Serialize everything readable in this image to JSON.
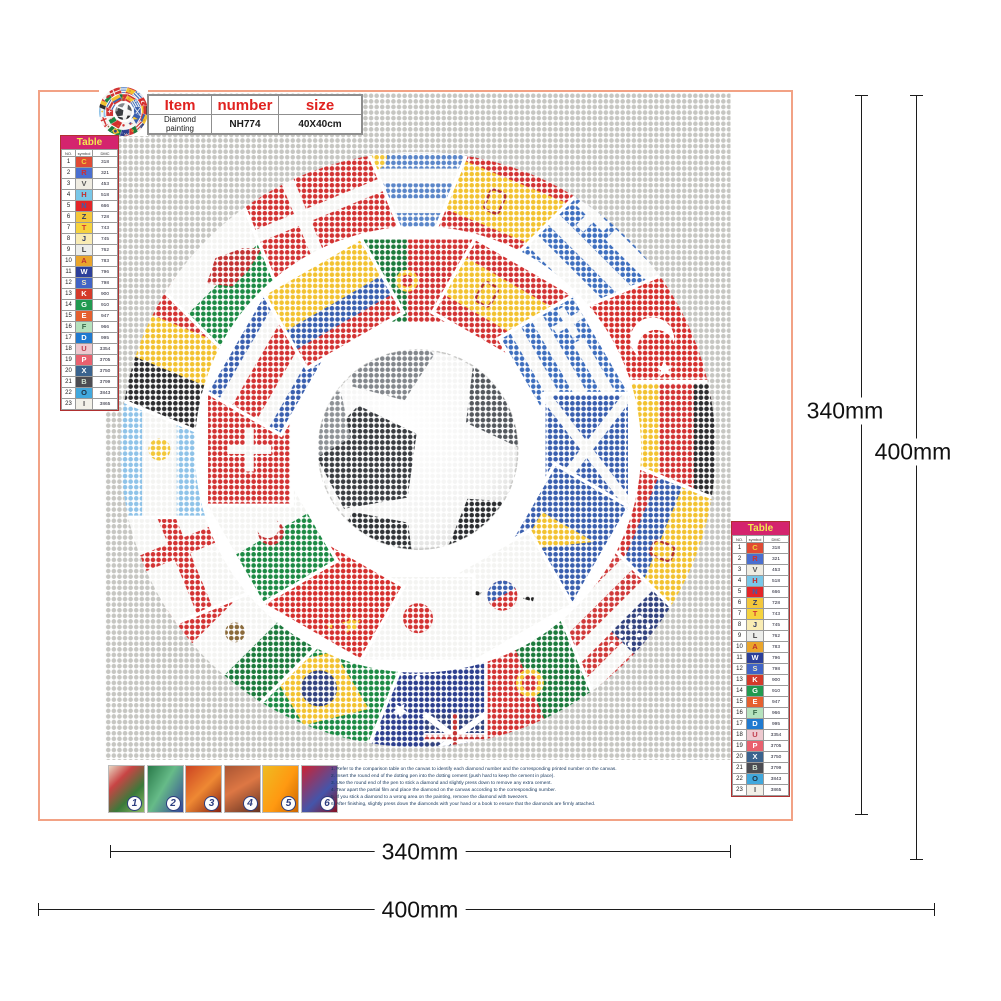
{
  "header": {
    "columns": [
      "Item",
      "number",
      "size"
    ],
    "product": "Diamond painting",
    "number": "NH774",
    "size": "40X40cm"
  },
  "color_table": {
    "title": "Table",
    "headers": [
      "NO.",
      "symbol",
      "DMC"
    ],
    "rows": [
      {
        "no": "1",
        "symbol": "C",
        "code": "318",
        "bg": "#e04b35",
        "fg": "#f2d23a"
      },
      {
        "no": "2",
        "symbol": "R",
        "code": "321",
        "bg": "#4a6fd0",
        "fg": "#d03030"
      },
      {
        "no": "3",
        "symbol": "V",
        "code": "453",
        "bg": "#efece2",
        "fg": "#555555"
      },
      {
        "no": "4",
        "symbol": "H",
        "code": "518",
        "bg": "#79c7e8",
        "fg": "#c03030"
      },
      {
        "no": "5",
        "symbol": "N",
        "code": "666",
        "bg": "#e32528",
        "fg": "#3a5fae"
      },
      {
        "no": "6",
        "symbol": "Z",
        "code": "728",
        "bg": "#f3c73b",
        "fg": "#2e3a66"
      },
      {
        "no": "7",
        "symbol": "T",
        "code": "743",
        "bg": "#f6d33d",
        "fg": "#cf3333"
      },
      {
        "no": "8",
        "symbol": "J",
        "code": "745",
        "bg": "#f9ecb4",
        "fg": "#2e3a66"
      },
      {
        "no": "9",
        "symbol": "L",
        "code": "762",
        "bg": "#ecedea",
        "fg": "#444444"
      },
      {
        "no": "10",
        "symbol": "A",
        "code": "783",
        "bg": "#eaa52b",
        "fg": "#c03030"
      },
      {
        "no": "11",
        "symbol": "W",
        "code": "796",
        "bg": "#2c3f9a",
        "fg": "#ffffff"
      },
      {
        "no": "12",
        "symbol": "S",
        "code": "798",
        "bg": "#4064c6",
        "fg": "#f0e8c0"
      },
      {
        "no": "13",
        "symbol": "K",
        "code": "900",
        "bg": "#d43a2a",
        "fg": "#ffffff"
      },
      {
        "no": "14",
        "symbol": "G",
        "code": "910",
        "bg": "#219a50",
        "fg": "#ffffff"
      },
      {
        "no": "15",
        "symbol": "E",
        "code": "947",
        "bg": "#e5602f",
        "fg": "#ffffff"
      },
      {
        "no": "16",
        "symbol": "F",
        "code": "966",
        "bg": "#b5e2bd",
        "fg": "#3a6a4a"
      },
      {
        "no": "17",
        "symbol": "D",
        "code": "995",
        "bg": "#1f7ad0",
        "fg": "#ffffff"
      },
      {
        "no": "18",
        "symbol": "U",
        "code": "3354",
        "bg": "#edc9cf",
        "fg": "#c04050"
      },
      {
        "no": "19",
        "symbol": "P",
        "code": "3705",
        "bg": "#e9606e",
        "fg": "#ffffff"
      },
      {
        "no": "20",
        "symbol": "X",
        "code": "3750",
        "bg": "#3a638e",
        "fg": "#ffffff"
      },
      {
        "no": "21",
        "symbol": "B",
        "code": "3799",
        "bg": "#4c4c52",
        "fg": "#cfe0cf"
      },
      {
        "no": "22",
        "symbol": "O",
        "code": "3843",
        "bg": "#41a8dd",
        "fg": "#223344"
      },
      {
        "no": "23",
        "symbol": "I",
        "code": "3865",
        "bg": "#f2f0e8",
        "fg": "#555555"
      }
    ]
  },
  "dimensions": {
    "right_inner": "340mm",
    "right_outer": "400mm",
    "bottom_inner": "340mm",
    "bottom_outer": "400mm"
  },
  "steps": [
    {
      "n": "1",
      "text": "1. Refer to the comparison table on the canvas to identify each diamond number and the corresponding printed number on the canvas."
    },
    {
      "n": "2",
      "text": "2. Insert the round end of the dotting pen into the dotting cement (push hard to keep the cement in place)."
    },
    {
      "n": "3",
      "text": "3. Use the round end of the pen to stick a diamond and slightly press down to remove any extra cement."
    },
    {
      "n": "4",
      "text": "4. Tear apart the partial film and place the diamond on the canvas according to the corresponding number."
    },
    {
      "n": "5",
      "text": "5. If you stick a diamond to a wrong area on the painting, remove the diamond with tweezers."
    },
    {
      "n": "6",
      "text": "6. After finishing, slightly press down the diamonds with your hand or a book to ensure that the diamonds are firmly attached."
    }
  ],
  "artwork": {
    "center": "soccer-ball",
    "colors": {
      "canvas_dot": "#c6c6c2",
      "gap_white": "#ffffff"
    },
    "outer_flags": [
      {
        "n": "uruguay",
        "d": "h",
        "c": [
          "#f4f4f2",
          "#5b86c8",
          "#f4f4f2",
          "#5b86c8",
          "#f4f4f2",
          "#5b86c8",
          "#f4f4f2"
        ],
        "e": [
          {
            "t": "disc",
            "x": -44,
            "y": -34,
            "r": 13,
            "c": "#f2c73a"
          }
        ]
      },
      {
        "n": "spain",
        "d": "h",
        "c": [
          "#d23333",
          "#f2c230",
          "#d23333"
        ],
        "w": [
          1,
          2,
          1
        ],
        "e": [
          {
            "t": "crest",
            "x": -24,
            "y": 0
          }
        ]
      },
      {
        "n": "greece",
        "d": "h",
        "c": [
          "#3f6fbe",
          "#f4f4f2",
          "#3f6fbe",
          "#f4f4f2",
          "#3f6fbe",
          "#f4f4f2",
          "#3f6fbe"
        ],
        "e": [
          {
            "t": "rect",
            "x": -68,
            "y": -52,
            "w": 52,
            "h": 42,
            "c": "#3f6fbe"
          },
          {
            "t": "cross",
            "x": -42,
            "y": -31,
            "s": 19,
            "th": 10,
            "c": "#f4f4f2"
          }
        ]
      },
      {
        "n": "turkey",
        "d": "solid",
        "c": [
          "#d5302e"
        ],
        "e": [
          {
            "t": "crescent",
            "x": -12,
            "y": 0,
            "r": 22,
            "c": "#ffffff",
            "bg": "#d5302e"
          },
          {
            "t": "star",
            "x": 20,
            "y": 0,
            "r": 9,
            "c": "#ffffff"
          }
        ]
      },
      {
        "n": "germany",
        "d": "h",
        "c": [
          "#2e2e30",
          "#d23333",
          "#f2c230"
        ]
      },
      {
        "n": "ecuador",
        "d": "h",
        "c": [
          "#f2c230",
          "#3a5fae",
          "#d23333"
        ],
        "w": [
          2,
          1,
          1
        ],
        "e": [
          {
            "t": "crest",
            "x": 0,
            "y": -6
          }
        ]
      },
      {
        "n": "usa",
        "d": "h",
        "c": [
          "#cf3a3a",
          "#f4f4f2",
          "#cf3a3a",
          "#f4f4f2",
          "#cf3a3a",
          "#f4f4f2",
          "#cf3a3a"
        ],
        "e": [
          {
            "t": "rect",
            "x": -68,
            "y": -52,
            "w": 60,
            "h": 45,
            "c": "#33437e"
          },
          {
            "t": "stars",
            "x": -38,
            "y": -29,
            "c": "#ffffff"
          }
        ]
      },
      {
        "n": "portugal",
        "d": "v",
        "c": [
          "#1d7a3c",
          "#d23333"
        ],
        "w": [
          2,
          3
        ],
        "e": [
          {
            "t": "disc",
            "x": -14,
            "y": 0,
            "r": 14,
            "c": "#f2c230"
          },
          {
            "t": "disc",
            "x": -14,
            "y": 0,
            "r": 8,
            "c": "#d23333"
          }
        ]
      },
      {
        "n": "australia",
        "d": "solid",
        "c": [
          "#2d3f8e"
        ],
        "e": [
          {
            "t": "uj",
            "x": -68,
            "y": -52,
            "w": 62,
            "h": 46
          },
          {
            "t": "stars2",
            "c": "#ffffff"
          }
        ]
      },
      {
        "n": "brazil",
        "d": "solid",
        "c": [
          "#1d8a44"
        ],
        "e": [
          {
            "t": "poly",
            "pts": [
              [
                -54,
                0
              ],
              [
                0,
                -40
              ],
              [
                54,
                0
              ],
              [
                0,
                40
              ]
            ],
            "c": "#f2c230"
          },
          {
            "t": "disc",
            "x": 0,
            "y": 0,
            "r": 18,
            "c": "#33437e"
          }
        ]
      },
      {
        "n": "mexico",
        "d": "v",
        "c": [
          "#1d7a3c",
          "#f4f4f2",
          "#d23333"
        ],
        "e": [
          {
            "t": "disc",
            "x": 0,
            "y": 0,
            "r": 10,
            "c": "#8a6a3a"
          }
        ]
      },
      {
        "n": "england",
        "d": "solid",
        "c": [
          "#f4f4f2"
        ],
        "e": [
          {
            "t": "crossfull",
            "th": 17,
            "c": "#d23333",
            "ox": 0
          }
        ]
      },
      {
        "n": "argentina",
        "d": "h",
        "c": [
          "#8fc3e8",
          "#f4f4f2",
          "#8fc3e8"
        ],
        "e": [
          {
            "t": "disc",
            "x": 0,
            "y": 0,
            "r": 11,
            "c": "#f2c73a"
          }
        ]
      },
      {
        "n": "belgium",
        "d": "v",
        "c": [
          "#2e2e30",
          "#f2c230",
          "#d23333"
        ]
      },
      {
        "n": "wales",
        "d": "h",
        "c": [
          "#f4f4f2",
          "#1d8a44"
        ],
        "e": [
          {
            "t": "poly",
            "pts": [
              [
                -32,
                -8
              ],
              [
                -8,
                -20
              ],
              [
                18,
                -8
              ],
              [
                32,
                6
              ],
              [
                6,
                12
              ],
              [
                -16,
                12
              ]
            ],
            "c": "#c23333"
          }
        ]
      },
      {
        "n": "denmark",
        "d": "solid",
        "c": [
          "#d23333"
        ],
        "e": [
          {
            "t": "crossfull",
            "th": 13,
            "c": "#f4f4f2",
            "ox": -18
          }
        ]
      }
    ],
    "inner_flags": [
      {
        "n": "portugal2",
        "d": "v",
        "c": [
          "#1d7a3c",
          "#d23333"
        ],
        "w": [
          2,
          3
        ],
        "e": [
          {
            "t": "disc",
            "x": -11,
            "y": 0,
            "r": 11,
            "c": "#f2c230"
          },
          {
            "t": "disc",
            "x": -11,
            "y": 0,
            "r": 6,
            "c": "#d23333"
          }
        ]
      },
      {
        "n": "spain2",
        "d": "h",
        "c": [
          "#d23333",
          "#f2c230",
          "#d23333"
        ],
        "w": [
          1,
          2,
          1
        ],
        "e": [
          {
            "t": "crest",
            "x": -18,
            "y": 0
          }
        ]
      },
      {
        "n": "greece2",
        "d": "h",
        "c": [
          "#3f6fbe",
          "#f4f4f2",
          "#3f6fbe",
          "#f4f4f2",
          "#3f6fbe",
          "#f4f4f2",
          "#3f6fbe"
        ],
        "e": [
          {
            "t": "rect",
            "x": -56,
            "y": -42,
            "w": 42,
            "h": 34,
            "c": "#3f6fbe"
          },
          {
            "t": "cross",
            "x": -35,
            "y": -25,
            "s": 16,
            "th": 8,
            "c": "#f4f4f2"
          }
        ]
      },
      {
        "n": "scotland",
        "d": "solid",
        "c": [
          "#3a5fae"
        ],
        "e": [
          {
            "t": "saltire",
            "th": 10,
            "c": "#f4f4f2"
          }
        ]
      },
      {
        "n": "bosnia",
        "d": "solid",
        "c": [
          "#3a5fae"
        ],
        "e": [
          {
            "t": "poly",
            "pts": [
              [
                -8,
                -30
              ],
              [
                36,
                30
              ],
              [
                -8,
                30
              ]
            ],
            "c": "#f2c230"
          }
        ]
      },
      {
        "n": "south-korea",
        "d": "solid",
        "c": [
          "#f4f4f2"
        ],
        "e": [
          {
            "t": "taegeuk",
            "x": 0,
            "y": 0,
            "r": 15
          }
        ]
      },
      {
        "n": "japan",
        "d": "solid",
        "c": [
          "#f4f4f2"
        ],
        "e": [
          {
            "t": "disc",
            "x": 0,
            "y": 0,
            "r": 15,
            "c": "#d23333"
          }
        ]
      },
      {
        "n": "china",
        "d": "solid",
        "c": [
          "#d5302e"
        ],
        "e": [
          {
            "t": "star",
            "x": -30,
            "y": -16,
            "r": 10,
            "c": "#f2c230"
          },
          {
            "t": "star",
            "x": -12,
            "y": -28,
            "r": 4,
            "c": "#f2c230"
          }
        ]
      },
      {
        "n": "algeria",
        "d": "v",
        "c": [
          "#1d8a44",
          "#f4f4f2"
        ],
        "e": [
          {
            "t": "crescent",
            "x": 2,
            "y": 0,
            "r": 13,
            "c": "#c23333",
            "bg": "#f4f4f2"
          }
        ]
      },
      {
        "n": "switzerland",
        "d": "solid",
        "c": [
          "#d23333"
        ],
        "e": [
          {
            "t": "cross",
            "x": 0,
            "y": 0,
            "s": 22,
            "th": 9,
            "c": "#f4f4f2"
          }
        ]
      },
      {
        "n": "costa-rica",
        "d": "h",
        "c": [
          "#3a5fae",
          "#f4f4f2",
          "#d23333",
          "#f4f4f2",
          "#3a5fae"
        ],
        "w": [
          1,
          1,
          2,
          1,
          1
        ]
      },
      {
        "n": "colombia",
        "d": "h",
        "c": [
          "#f2c230",
          "#3a5fae",
          "#d23333"
        ],
        "w": [
          2,
          1,
          1
        ]
      }
    ]
  }
}
